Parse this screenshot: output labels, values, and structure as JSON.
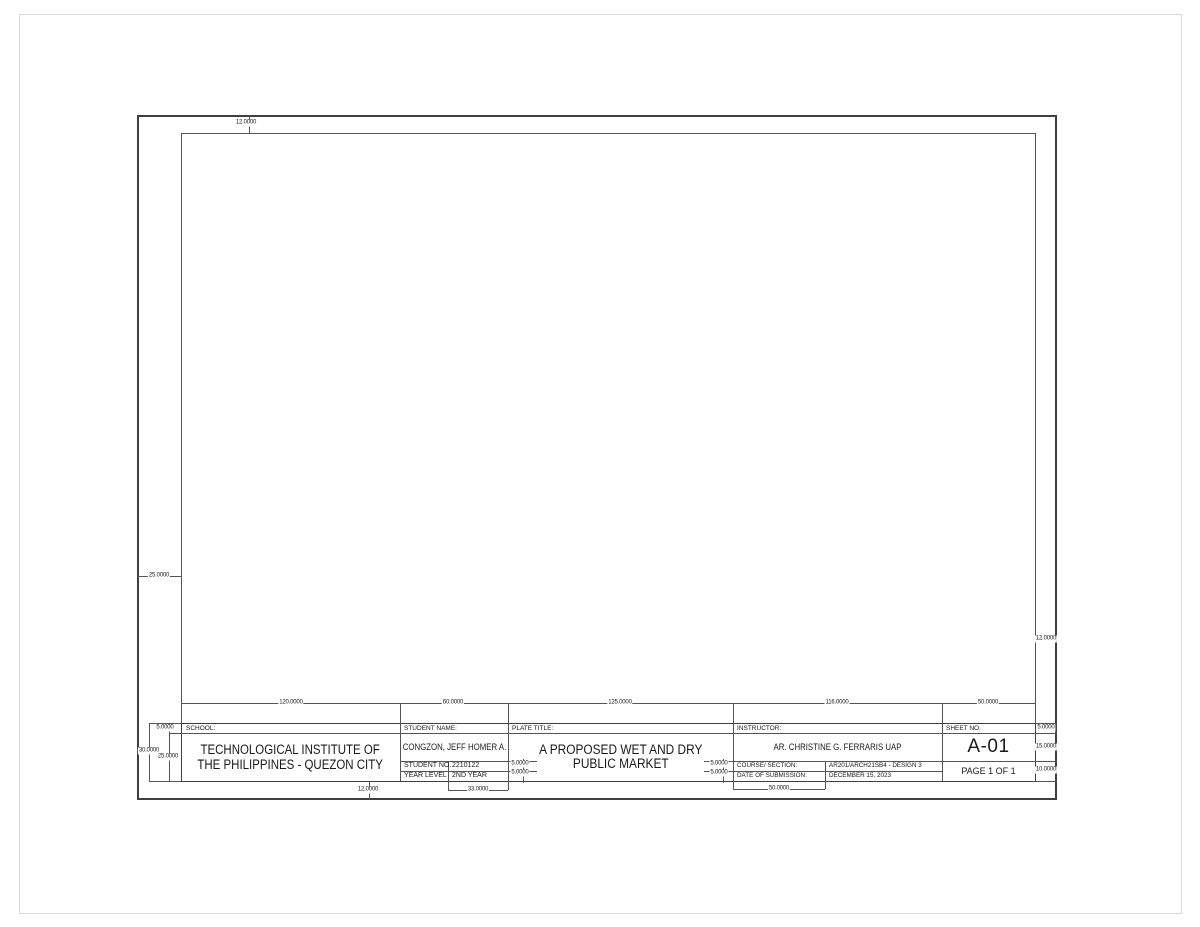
{
  "title_block": {
    "school": {
      "label": "SCHOOL:",
      "name_line1": "TECHNOLOGICAL INSTITUTE OF",
      "name_line2": "THE PHILIPPINES - QUEZON CITY"
    },
    "student": {
      "label": "STUDENT NAME:",
      "name": "CONGZON, JEFF HOMER A.",
      "student_no_label": "STUDENT NO.",
      "student_no": "2210122",
      "year_level_label": "YEAR LEVEL",
      "year_level": "2ND YEAR"
    },
    "plate": {
      "label": "PLATE TITLE:",
      "title_line1": "A PROPOSED WET AND DRY",
      "title_line2": "PUBLIC MARKET"
    },
    "instructor": {
      "label": "INSTRUCTOR:",
      "name": "AR. CHRISTINE G. FERRARIS UAP",
      "course_label": "COURSE/ SECTION:",
      "course": "AR201/ARCH21SB4 - DESIGN 3",
      "date_label": "DATE OF SUBMISSION:",
      "date": "DECEMBER 15, 2023"
    },
    "sheet": {
      "label": "SHEET NO.",
      "number": "A-01",
      "page": "PAGE 1 OF 1"
    }
  },
  "dims": {
    "top_margin": "12.0000",
    "left_margin": "25.0000",
    "right_margin": "12.0000",
    "bottom_margin": "12.0000",
    "school_width": "120.0000",
    "student_width": "60.0000",
    "plate_width": "125.0000",
    "instructor_width": "116.0000",
    "sheet_width": "50.0000",
    "header_row_height": "5.0000",
    "block_height": "30.0000",
    "body_height": "25.0000",
    "student_no_row_height": "5.0000",
    "year_level_row_height": "5.0000",
    "course_row_height": "5.0000",
    "date_row_height": "5.0000",
    "sheet_header_row_height": "5.0000",
    "sheet_no_row_height": "15.0000",
    "page_row_height": "10.0000",
    "student_value_width": "33.0000",
    "instructor_label_width": "50.0000"
  },
  "colors": {
    "line": "#555555",
    "border": "#3f3f3f",
    "paper_edge": "#d9d9d9",
    "text": "#1a1a1a"
  }
}
